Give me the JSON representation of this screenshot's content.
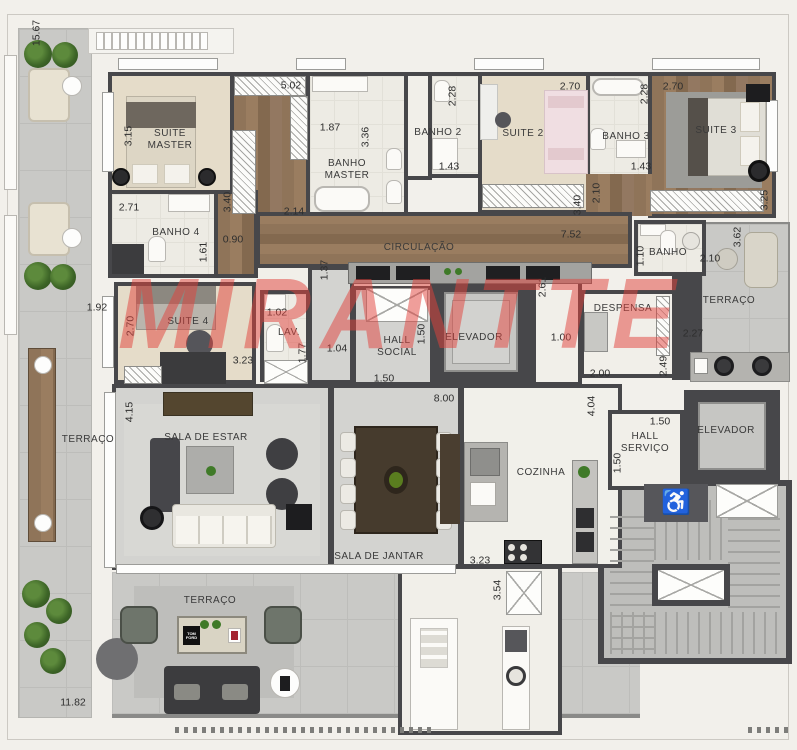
{
  "watermark": {
    "text": "MIRANTTE",
    "color": "#e2423c"
  },
  "palette": {
    "wall": "#47474a",
    "wood": "#8f7459",
    "terrace_tile": "#c9c9c6",
    "carpet": "#e5dcc9",
    "bath": "#edebe4",
    "gray_floor": "#d3d3d0",
    "watermark_red": "#e2423c",
    "plant_green": "#3d6527"
  },
  "icons": {
    "wheelchair_glyph": "♿"
  },
  "terrace_bottom": {
    "book": "TOM FORD"
  },
  "room_labels": [
    {
      "name": "room-label-suite-master",
      "text": "SUITE\nMASTER",
      "x": 170,
      "y": 140
    },
    {
      "name": "room-label-banho-master",
      "text": "BANHO\nMASTER",
      "x": 347,
      "y": 170
    },
    {
      "name": "room-label-banho-2",
      "text": "BANHO 2",
      "x": 438,
      "y": 133
    },
    {
      "name": "room-label-suite-2",
      "text": "SUITE 2",
      "x": 523,
      "y": 134
    },
    {
      "name": "room-label-banho-3",
      "text": "BANHO 3",
      "x": 626,
      "y": 137
    },
    {
      "name": "room-label-suite-3",
      "text": "SUITE 3",
      "x": 716,
      "y": 131
    },
    {
      "name": "room-label-banho-4",
      "text": "BANHO 4",
      "x": 176,
      "y": 233
    },
    {
      "name": "room-label-circulacao",
      "text": "CIRCULAÇÃO",
      "x": 419,
      "y": 248
    },
    {
      "name": "room-label-banho",
      "text": "BANHO",
      "x": 668,
      "y": 253
    },
    {
      "name": "room-label-terraco-right",
      "text": "TERRAÇO",
      "x": 729,
      "y": 301
    },
    {
      "name": "room-label-suite-4",
      "text": "SUITE 4",
      "x": 188,
      "y": 322
    },
    {
      "name": "room-label-lav",
      "text": "LAV.",
      "x": 289,
      "y": 333
    },
    {
      "name": "room-label-hall-social",
      "text": "HALL\nSOCIAL",
      "x": 397,
      "y": 347
    },
    {
      "name": "room-label-elevador-social",
      "text": "ELEVADOR",
      "x": 474,
      "y": 338
    },
    {
      "name": "room-label-despensa",
      "text": "DESPENSA",
      "x": 623,
      "y": 309
    },
    {
      "name": "room-label-terraco-left",
      "text": "TERRAÇO",
      "x": 88,
      "y": 440
    },
    {
      "name": "room-label-sala-de-estar",
      "text": "SALA DE ESTAR",
      "x": 206,
      "y": 438
    },
    {
      "name": "room-label-sala-de-jantar",
      "text": "SALA DE JANTAR",
      "x": 379,
      "y": 557
    },
    {
      "name": "room-label-cozinha",
      "text": "COZINHA",
      "x": 541,
      "y": 473
    },
    {
      "name": "room-label-hall-servico",
      "text": "HALL\nSERVIÇO",
      "x": 645,
      "y": 443
    },
    {
      "name": "room-label-elevador-servico",
      "text": "ELEVADOR",
      "x": 726,
      "y": 431
    },
    {
      "name": "room-label-terraco-bottom",
      "text": "TERRAÇO",
      "x": 210,
      "y": 601
    }
  ],
  "dimensions": [
    {
      "text": "15.67",
      "x": 37,
      "y": 33,
      "v": true
    },
    {
      "text": "3.15",
      "x": 129,
      "y": 136,
      "v": true
    },
    {
      "text": "5.02",
      "x": 291,
      "y": 86
    },
    {
      "text": "3.40",
      "x": 228,
      "y": 202,
      "v": true
    },
    {
      "text": "2.14",
      "x": 294,
      "y": 212
    },
    {
      "text": "1.87",
      "x": 330,
      "y": 128
    },
    {
      "text": "3.36",
      "x": 366,
      "y": 137,
      "v": true
    },
    {
      "text": "2.28",
      "x": 453,
      "y": 96,
      "v": true
    },
    {
      "text": "1.43",
      "x": 449,
      "y": 167
    },
    {
      "text": "2.70",
      "x": 570,
      "y": 87
    },
    {
      "text": "3.40",
      "x": 578,
      "y": 205,
      "v": true
    },
    {
      "text": "2.28",
      "x": 645,
      "y": 94,
      "v": true
    },
    {
      "text": "1.43",
      "x": 641,
      "y": 167
    },
    {
      "text": "2.70",
      "x": 673,
      "y": 87
    },
    {
      "text": "3.25",
      "x": 765,
      "y": 200,
      "v": true
    },
    {
      "text": "2.71",
      "x": 129,
      "y": 208
    },
    {
      "text": "1.61",
      "x": 204,
      "y": 252,
      "v": true
    },
    {
      "text": "0.90",
      "x": 233,
      "y": 240
    },
    {
      "text": "2.10",
      "x": 597,
      "y": 193,
      "v": true
    },
    {
      "text": "7.52",
      "x": 571,
      "y": 235
    },
    {
      "text": "3.62",
      "x": 738,
      "y": 237,
      "v": true
    },
    {
      "text": "1.10",
      "x": 641,
      "y": 256,
      "v": true
    },
    {
      "text": "2.10",
      "x": 710,
      "y": 259
    },
    {
      "text": "2.27",
      "x": 693,
      "y": 334
    },
    {
      "text": "1.92",
      "x": 97,
      "y": 308
    },
    {
      "text": "2.70",
      "x": 131,
      "y": 326,
      "v": true
    },
    {
      "text": "3.23",
      "x": 243,
      "y": 361
    },
    {
      "text": "1.02",
      "x": 277,
      "y": 313
    },
    {
      "text": "1.77",
      "x": 303,
      "y": 353,
      "v": true
    },
    {
      "text": "1.37",
      "x": 325,
      "y": 270,
      "v": true
    },
    {
      "text": "1.04",
      "x": 337,
      "y": 349
    },
    {
      "text": "1.50",
      "x": 422,
      "y": 334,
      "v": true
    },
    {
      "text": "1.50",
      "x": 384,
      "y": 379
    },
    {
      "text": "2.61",
      "x": 543,
      "y": 287,
      "v": true
    },
    {
      "text": "1.00",
      "x": 561,
      "y": 338
    },
    {
      "text": "2.00",
      "x": 600,
      "y": 374
    },
    {
      "text": "2.49",
      "x": 664,
      "y": 366,
      "v": true
    },
    {
      "text": "4.15",
      "x": 130,
      "y": 412,
      "v": true
    },
    {
      "text": "8.00",
      "x": 444,
      "y": 399
    },
    {
      "text": "3.23",
      "x": 480,
      "y": 561
    },
    {
      "text": "4.04",
      "x": 592,
      "y": 406,
      "v": true
    },
    {
      "text": "1.50",
      "x": 660,
      "y": 422
    },
    {
      "text": "1.50",
      "x": 618,
      "y": 463,
      "v": true
    },
    {
      "text": "3.54",
      "x": 498,
      "y": 590,
      "v": true
    },
    {
      "text": "11.82",
      "x": 73,
      "y": 703
    }
  ]
}
